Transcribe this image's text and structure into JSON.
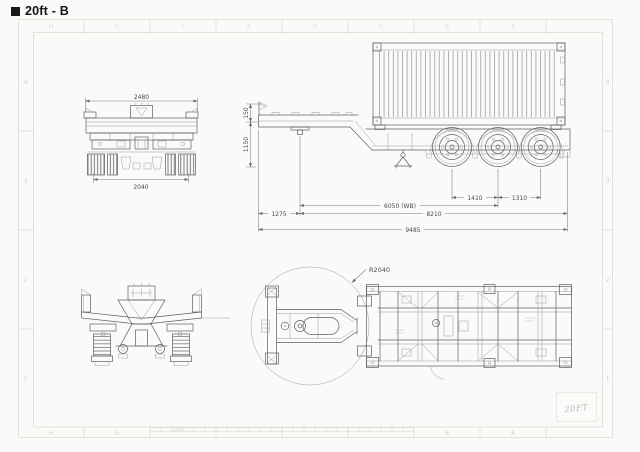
{
  "title": "20ft - B",
  "handwritten_note": "20FT",
  "frame": {
    "row_labels": [
      "4",
      "3",
      "2",
      "1"
    ],
    "column_labels": [
      "H",
      "G",
      "F",
      "E",
      "D",
      "C",
      "B",
      "A"
    ]
  },
  "views": {
    "rear_view": {
      "name": "rear view",
      "dim_overall_width": "2480",
      "dim_track_width": "2040"
    },
    "side_view": {
      "name": "side view with 20ft container",
      "dim_neck_height": "150",
      "dim_deck_height": "1150",
      "dim_kingpin_setback": "1275",
      "dim_wheelbase": "6050 (WB)",
      "dim_kingpin_to_rear": "8210",
      "dim_overall_length": "9485",
      "dim_axle_spacing_front": "1410",
      "dim_axle_spacing_rear": "1310"
    },
    "front_view": {
      "name": "front view"
    },
    "plan_view": {
      "name": "plan view",
      "dim_swing_radius": "R2040"
    }
  },
  "colors": {
    "paper": "#fafaf8",
    "drawing_line": "#5f5f5f",
    "dim_text": "#4a4a4a",
    "frame_border": "#dcdcd6",
    "title_text": "#141414",
    "handwriting": "#b6b6b0"
  }
}
